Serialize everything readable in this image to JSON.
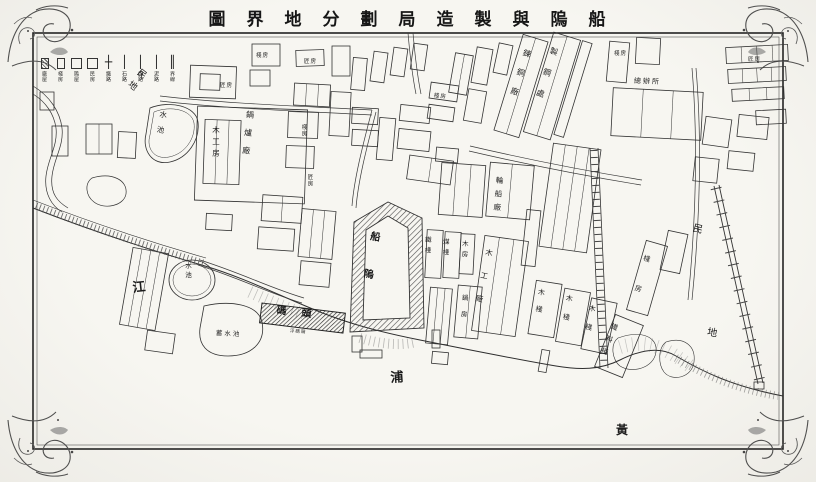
{
  "title": {
    "text": "圖　界　地　分　劃　局　造　製　與　隖　船"
  },
  "legend": {
    "items": [
      {
        "symbol": "square-hatched",
        "glyph": "",
        "label": "廠屋"
      },
      {
        "symbol": "square",
        "glyph": "",
        "label": "棧房"
      },
      {
        "symbol": "square-bold",
        "glyph": "",
        "label": "隖屋"
      },
      {
        "symbol": "square-thin",
        "glyph": "",
        "label": "民房"
      },
      {
        "symbol": "cross-line",
        "glyph": "┼",
        "label": "鐵路"
      },
      {
        "symbol": "line-thick",
        "glyph": "│",
        "label": "石路"
      },
      {
        "symbol": "line-medium",
        "glyph": "│",
        "label": "煤路"
      },
      {
        "symbol": "line-thin",
        "glyph": "│",
        "label": "泥路"
      },
      {
        "symbol": "line-double",
        "glyph": "║",
        "label": "界線"
      }
    ]
  },
  "map": {
    "river": {
      "name": "黃浦江",
      "char_huang": "黃",
      "char_pu": "浦",
      "char_jiang": "江"
    },
    "areas": {
      "mindi_top_left": "民地",
      "mindi_right_top": "民",
      "mindi_right_bottom": "地"
    },
    "features": {
      "dock": "船隖",
      "wharf": "碼頭",
      "wharf_caption": "浮碼頭",
      "boiler_works": "鍋爐廠",
      "carpentry_house": "木工房",
      "pond1": "水池",
      "pond2": "水池",
      "reservoir": "蓄水池",
      "copper_refinery": "鍊銅廠",
      "steel_works": "製鋼處",
      "shipbuilding_shop": "輪船廠",
      "iron_yard": "鐵棧",
      "coal_yard": "煤棧",
      "wood_house": "木房",
      "woodwork_shop": "木工廠",
      "boiler_house": "鍋房",
      "timber_yard_1": "木棧",
      "timber_yard_2": "木棧",
      "timber_yard_3": "木棧",
      "material_yard": "鐵料棧",
      "warehouse_right": "棧房",
      "head_office": "總辦所",
      "small_1": "匠房",
      "small_2": "棧房",
      "small_3": "匠房",
      "small_4": "棧房",
      "small_5": "匠房",
      "small_6": "棧房",
      "small_7": "棧房",
      "small_8": "匠房"
    }
  }
}
